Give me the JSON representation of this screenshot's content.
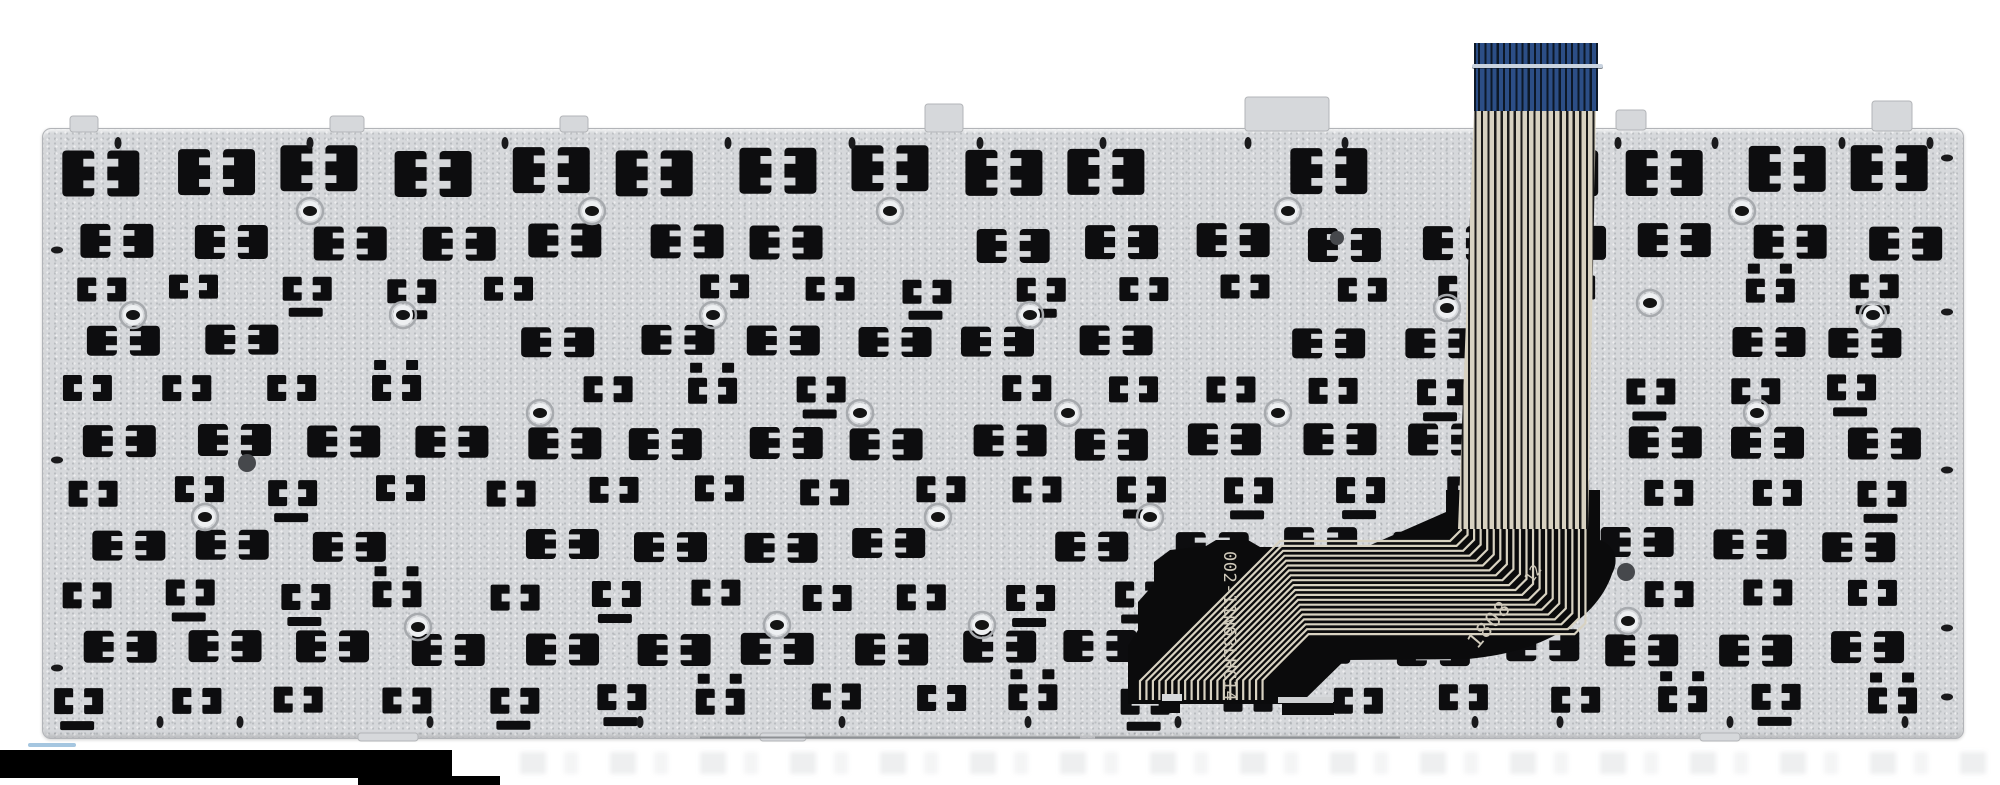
{
  "meta": {
    "description": "Product photo: rear (underside) view of a silver laptop keyboard replacement panel with rows of black key-clip cutouts, screw holes, a blue-tipped flat flex ribbon cable at top and a black printed flex circuit fan-out at bottom right of center.",
    "subject": "laptop-keyboard-backplate"
  },
  "colors": {
    "background": "#ffffff",
    "plate": "#d6d8db",
    "plate_edge": "#b2b4b8",
    "cutout": "#0d0d0f",
    "ring_stroke": "#a7aaae",
    "ring_center": "#eef0f2",
    "rivet": "#1a1a1c",
    "ribbon_blue": "#2c4e86",
    "ribbon_blue_dark": "#0d1827",
    "ribbon_header_line": "#c9d3df",
    "ribbon_conductor": "#d8d2c1",
    "ribbon_gap": "#1b1b1b",
    "flex_black": "#0b0b0c",
    "flex_trace": "#d8d2c1",
    "flex_text": "#cfc9ba",
    "watermark_bar": "#000000"
  },
  "flex": {
    "part_number": "002-11N63LHC14",
    "date_code": "1808",
    "date_code_suffix": "12"
  },
  "plate": {
    "pattern_rows": [
      {
        "y": 148,
        "variant": "tall",
        "h": 46,
        "x0": 62,
        "pitch": 112,
        "n": 17
      },
      {
        "y": 226,
        "variant": "med",
        "h": 34,
        "x0": 88,
        "pitch": 111,
        "n": 17
      },
      {
        "y": 277,
        "variant": "bits",
        "h": 24,
        "x0": 70,
        "pitch": 105,
        "n": 18
      },
      {
        "y": 326,
        "variant": "med",
        "h": 30,
        "x0": 92,
        "pitch": 109,
        "n": 17
      },
      {
        "y": 377,
        "variant": "bits",
        "h": 26,
        "x0": 66,
        "pitch": 104,
        "n": 18
      },
      {
        "y": 426,
        "variant": "med",
        "h": 32,
        "x0": 86,
        "pitch": 110,
        "n": 17
      },
      {
        "y": 478,
        "variant": "bits",
        "h": 26,
        "x0": 62,
        "pitch": 106,
        "n": 18
      },
      {
        "y": 530,
        "variant": "med",
        "h": 30,
        "x0": 90,
        "pitch": 108,
        "n": 17
      },
      {
        "y": 582,
        "variant": "bits",
        "h": 26,
        "x0": 64,
        "pitch": 105,
        "n": 18
      },
      {
        "y": 632,
        "variant": "med",
        "h": 32,
        "x0": 86,
        "pitch": 109,
        "n": 17
      },
      {
        "y": 686,
        "variant": "bits",
        "h": 26,
        "x0": 62,
        "pitch": 106,
        "n": 18
      }
    ],
    "screw_rings": [
      [
        310,
        211
      ],
      [
        592,
        211
      ],
      [
        890,
        211
      ],
      [
        1288,
        211
      ],
      [
        1742,
        211
      ],
      [
        133,
        315
      ],
      [
        403,
        315
      ],
      [
        713,
        315
      ],
      [
        1030,
        315
      ],
      [
        1447,
        308
      ],
      [
        1873,
        315
      ],
      [
        540,
        413
      ],
      [
        860,
        413
      ],
      [
        1068,
        413
      ],
      [
        1278,
        413
      ],
      [
        1650,
        303
      ],
      [
        1757,
        413
      ],
      [
        205,
        517
      ],
      [
        938,
        517
      ],
      [
        1150,
        517
      ],
      [
        418,
        627
      ],
      [
        777,
        625
      ],
      [
        982,
        625
      ],
      [
        1628,
        621
      ]
    ],
    "rivet_holes_top_y": 143,
    "rivet_holes_top_x": [
      118,
      310,
      505,
      728,
      852,
      980,
      1103,
      1248,
      1345,
      1618,
      1715,
      1842,
      1930
    ],
    "rivet_holes_bottom_y": 722,
    "rivet_holes_bottom_x": [
      160,
      240,
      430,
      640,
      842,
      1028,
      1178,
      1475,
      1560,
      1730,
      1905
    ],
    "rivet_holes_left_x": 57,
    "rivet_holes_left_y": [
      250,
      460,
      668
    ],
    "rivet_holes_right_x": 1947,
    "rivet_holes_right_y": [
      158,
      312,
      470,
      628,
      697
    ],
    "dark_spots": [
      [
        1626,
        572,
        9
      ],
      [
        1337,
        238,
        7
      ],
      [
        247,
        463,
        9
      ]
    ],
    "edge_tabs": [
      [
        925,
        104,
        38,
        28
      ],
      [
        1245,
        97,
        84,
        34
      ],
      [
        1872,
        101,
        40,
        30
      ],
      [
        70,
        116,
        28,
        16
      ],
      [
        330,
        116,
        34,
        16
      ],
      [
        560,
        116,
        28,
        16
      ],
      [
        1616,
        110,
        30,
        20
      ],
      [
        358,
        733,
        60,
        8
      ],
      [
        760,
        733,
        46,
        8
      ],
      [
        1700,
        733,
        40,
        8
      ]
    ]
  }
}
